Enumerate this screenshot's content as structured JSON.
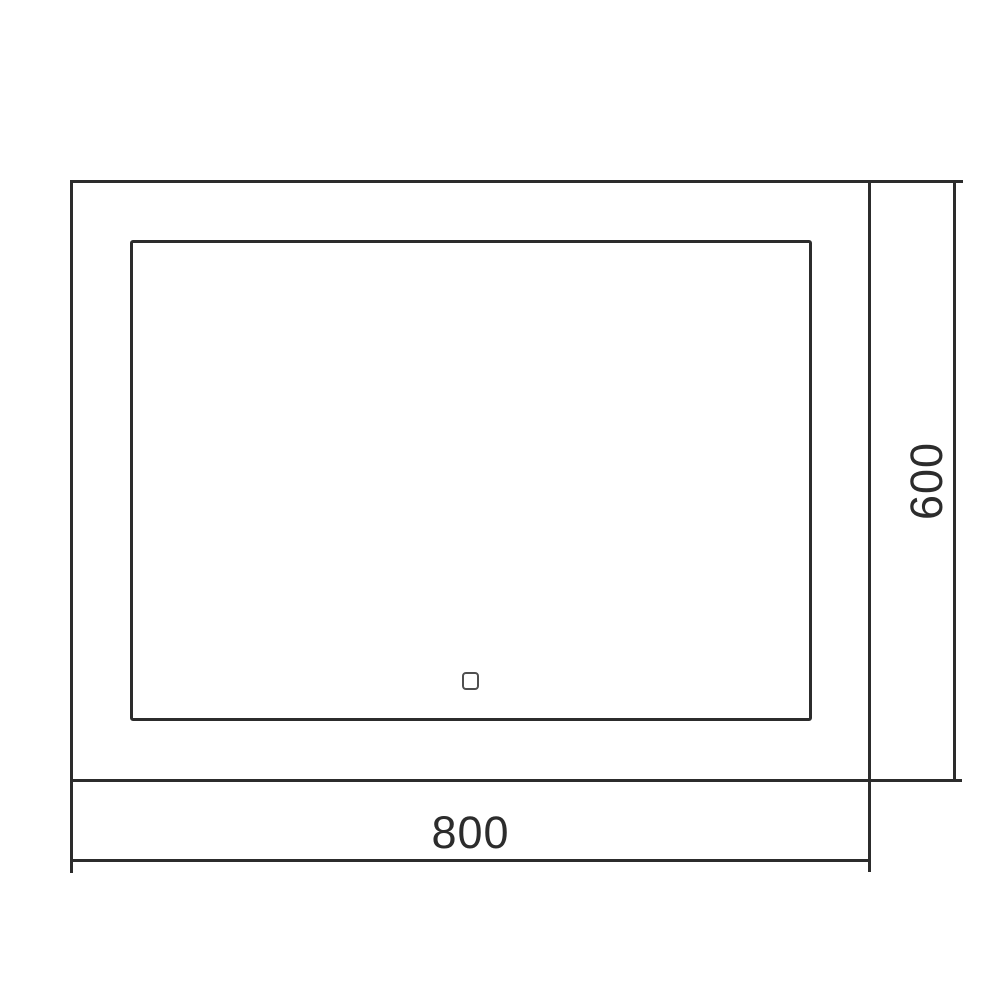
{
  "drawing": {
    "width_label": "800",
    "height_label": "600"
  },
  "colors": {
    "line": "#2c2c2c",
    "text": "#2c2c2c",
    "sensor-line": "#4f4f4f",
    "background": "#ffffff"
  }
}
